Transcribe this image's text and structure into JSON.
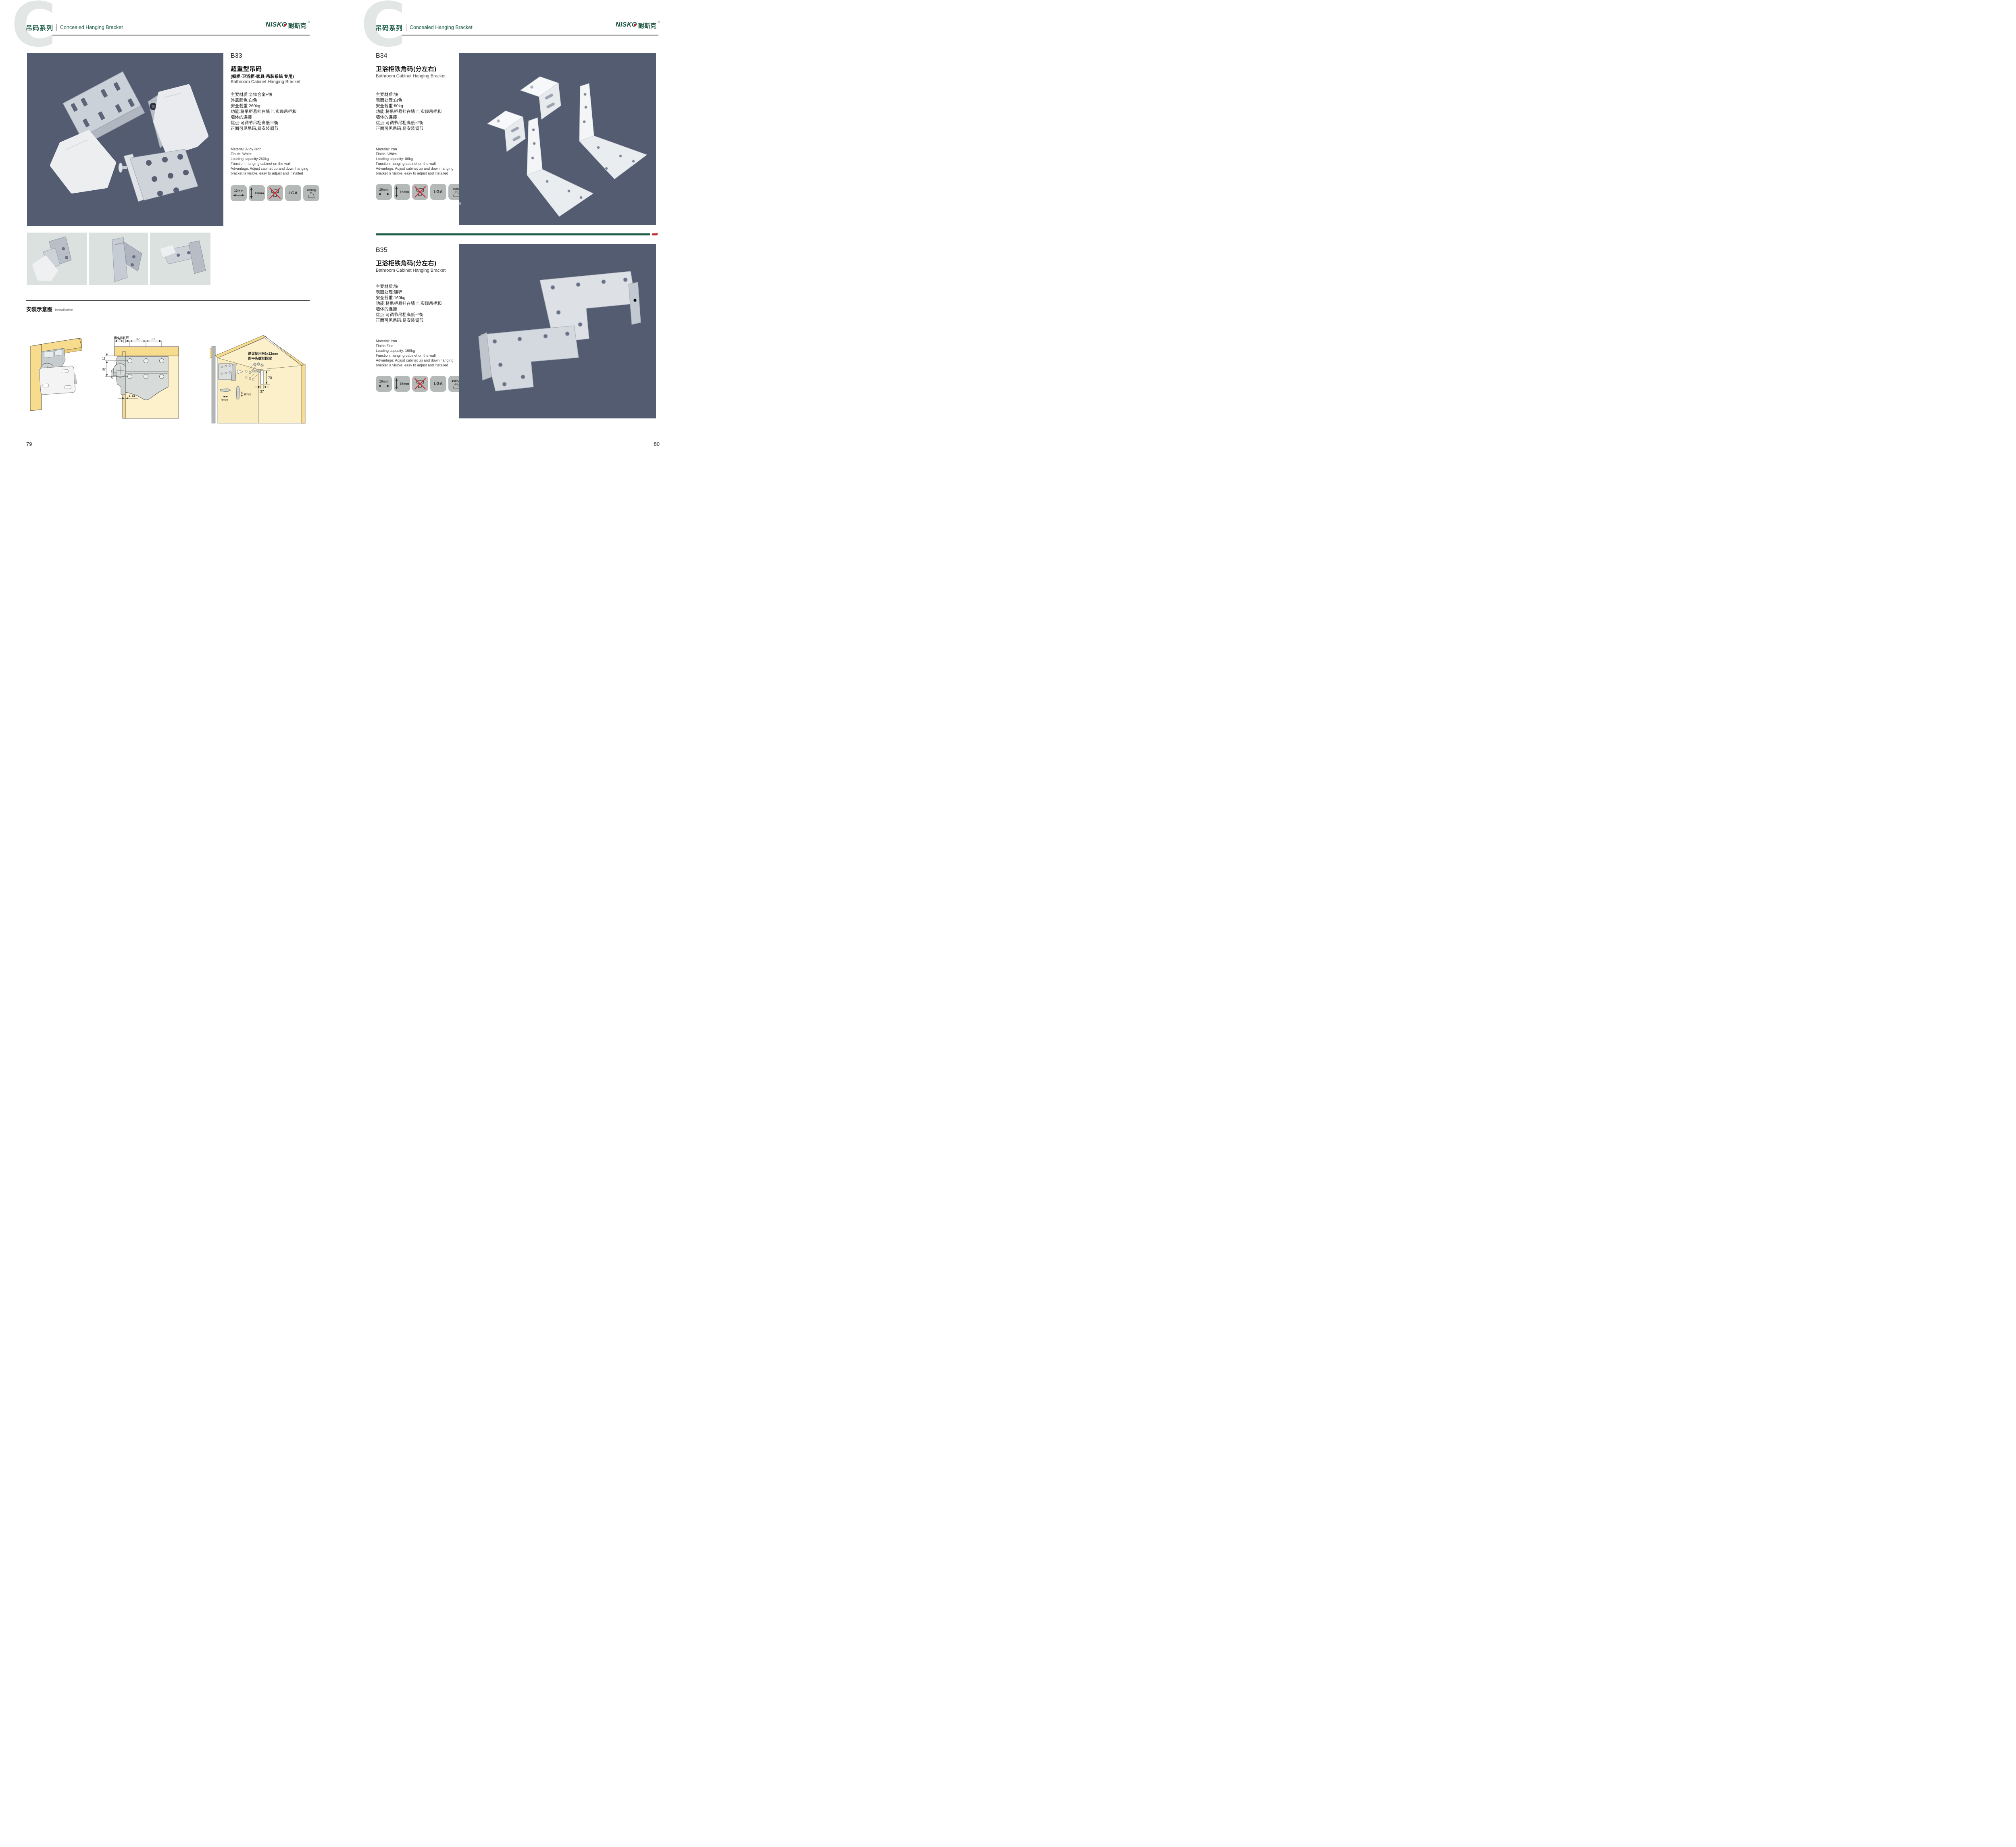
{
  "header": {
    "series_cn": "吊码系列",
    "series_en": "Concealed Hanging Bracket",
    "watermark_letter": "C"
  },
  "brand": {
    "wordmark": "NISKO",
    "cn": "耐斯克",
    "reg": "®"
  },
  "colors": {
    "brand_green": "#1c5b45",
    "accent_red": "#c1272d",
    "photo_background_navy": "#545c72",
    "badge_gray": "#b5bab8",
    "thumb_gray": "#dbe1df"
  },
  "products": {
    "b33": {
      "code": "B33",
      "title_cn": "超重型吊码",
      "subtitle_cn": "(橱柜·卫浴柜·家具·吊装系统 专用)",
      "title_en": "Bathroom Cabinet Hanging Bracket",
      "specs_cn": "主要材质:全锌合金+铁\n外盖颜色:白色\n安全载重:260kg\n功能:将吊柜悬挂在墙上,实现吊柜和\n墙体的连接\n优点:可调节吊柜高低平衡\n正面可见吊码,易安装调节",
      "specs_en": "Material: Alloy+iron\nFinish: White\nLoading capacity:260kg\nFunction: hanging cabinet on the wall\nAdvantage: Adjust cabinet up and down hanging\nbracket is visible, easy to adjust and installed",
      "badges": {
        "width": "12mm",
        "height": "13mm",
        "cert": "LGA",
        "load": "260Kg"
      }
    },
    "b34": {
      "code": "B34",
      "title_cn": "卫浴柜铁角码(分左右)",
      "title_en": "Bathroom Cabinet Hanging Bracket",
      "specs_cn": "主要材质:铁\n表面处理:白色\n安全载重:80kg\n功能:将吊柜悬挂在墙上,实现吊柜和\n墙体的连接\n优点:可调节吊柜高低平衡\n正面可见吊码,易安装调节",
      "specs_en": "Material: Iron\nFinish: White\nLoading capacity: 80kg\nFunction: hanging cabinet on the wall\nAdvantage: Adjust cabinet up and down hanging\nbracket is visible, easy to adjust and installed",
      "badges": {
        "width": "10mm",
        "height": "15mm",
        "cert": "LGA",
        "load": "80Kg"
      }
    },
    "b35": {
      "code": "B35",
      "title_cn": "卫浴柜铁角码(分左右)",
      "title_en": "Bathroom Cabinet Hanging Bracket",
      "specs_cn": "主要材质:铁\n表面处理:镀锌\n安全载重:160kg\n功能:将吊柜悬挂在墙上,实现吊柜和\n墙体的连接\n优点:可调节吊柜高低平衡\n正面可见吊码,易安装调节",
      "specs_en": "Material: Iron\nFinish:Zinc\nLoading capacity: 160kg\nFunction: hanging cabinet on the wall\nAdvantage: Adjust cabinet up and down hanging\nbracket is visible, easy to adjust and installed",
      "badges": {
        "width": "10mm",
        "height": "15mm",
        "cert": "LGA",
        "load": "160KG"
      }
    }
  },
  "installation": {
    "heading_cn": "安装示意图",
    "heading_en": "Installation",
    "section_view": {
      "min_gap_label": "最小间距",
      "dim_20": "20",
      "dim_10": "10",
      "dim_32a": "32",
      "dim_32b": "32",
      "dim_11": "11",
      "dim_32c": "32",
      "dim_range": "4-14"
    },
    "cabinet_view": {
      "note_l1": "建议使用M6x12mm",
      "note_l2": "的平头螺丝固定",
      "dim_78": "78",
      "dim_37": "37",
      "dim_9a": "9mm",
      "dim_9b": "9mm"
    }
  },
  "footer": {
    "page_left": "79",
    "page_right": "80"
  }
}
